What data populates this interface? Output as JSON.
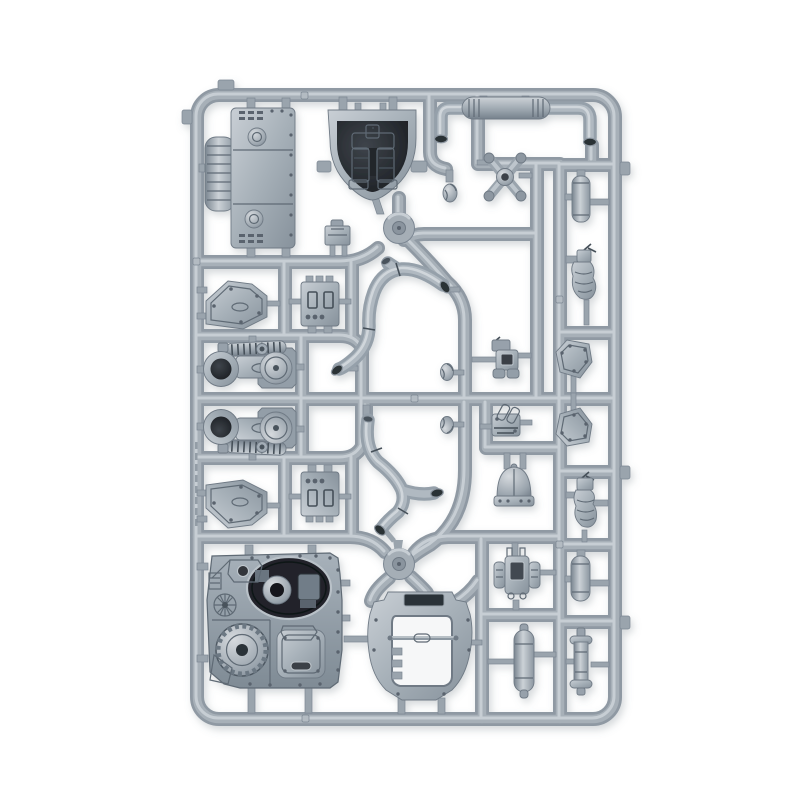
{
  "scene": {
    "type": "product photograph",
    "subject": "Injection-moulded plastic model sprue with unassembled miniature vehicle parts",
    "background_color": "#ffffff",
    "shadow_color": "#6a7480"
  },
  "sprue": {
    "frame_shape": "rounded rectangle",
    "hub_count": 2,
    "material": "light blue-grey polystyrene",
    "colors": {
      "plastic_light": "#c7ced4",
      "plastic_mid": "#9aa4ad",
      "plastic_dark": "#6f7a85",
      "recess_dark": "#2c3137"
    }
  },
  "parts": [
    {
      "id": "runner-frame",
      "label": "moulding frame and runner network with two round injection hubs"
    },
    {
      "id": "engine-block",
      "label": "boxy engine block with vent slots, round caps and ribbed cylinder"
    },
    {
      "id": "servitor-recess",
      "label": "oval recess holding a robotic servitor torso with twin legs"
    },
    {
      "id": "exhaust-assembly",
      "label": "twin down-curved exhaust pipes joined by a ribbed silencer"
    },
    {
      "id": "head-1",
      "label": "small bare head"
    },
    {
      "id": "servo-harness",
      "label": "X-shaped servo harness with four socket arms"
    },
    {
      "id": "cylinder-1",
      "label": "small plain cylinder canister"
    },
    {
      "id": "servitor-arm-1",
      "label": "small hunched servitor figure with antenna"
    },
    {
      "id": "clamp-box",
      "label": "small clamp box with stud feet"
    },
    {
      "id": "angled-plate-1",
      "label": "angular armour plate with bolt heads"
    },
    {
      "id": "stud-box-1",
      "label": "rectangular box with studs and triple rivet detail"
    },
    {
      "id": "weapon-assembly-1",
      "label": "weapon mount with muzzle ring, spring coil and round drum"
    },
    {
      "id": "head-2",
      "label": "small helmeted head"
    },
    {
      "id": "torso-front",
      "label": "torso front plate with recessed square vent"
    },
    {
      "id": "hatch-plate-1",
      "label": "pentagonal hatch plate with bolts"
    },
    {
      "id": "weapon-assembly-2",
      "label": "mirrored weapon mount with muzzle ring, coil and drum"
    },
    {
      "id": "head-3",
      "label": "small helmeted head, mirrored"
    },
    {
      "id": "hatch-plate-2",
      "label": "pentagonal hatch plate with bolts, mirrored"
    },
    {
      "id": "angled-plate-2",
      "label": "angular armour plate with bolt heads, mirrored"
    },
    {
      "id": "stud-box-2",
      "label": "rectangular box with studs, mirrored"
    },
    {
      "id": "engine-greeble",
      "label": "small engine chunk with piston cylinders"
    },
    {
      "id": "dome-vent",
      "label": "rounded dome vent on bolted base flange"
    },
    {
      "id": "power-pack",
      "label": "power pack with recessed core and side pods"
    },
    {
      "id": "servitor-arm-2",
      "label": "small segmented servo arm figure"
    },
    {
      "id": "cylinder-2",
      "label": "capped cylinder canister"
    },
    {
      "id": "smoke-launcher",
      "label": "flanged smoke launcher tube"
    },
    {
      "id": "fuel-tank",
      "label": "rounded fuel tank pill with ring seams"
    },
    {
      "id": "hull-side-panel",
      "label": "large hull side panel with turret recess, toothed gear wheel and access hatch"
    },
    {
      "id": "hatch-arch",
      "label": "arched hatch surround with open centre, cross rod and top slot"
    },
    {
      "id": "exhaust-pipe-1",
      "label": "S-curved exhaust pipe with flared mouths"
    },
    {
      "id": "exhaust-pipe-2",
      "label": "mirrored S-curved exhaust pipe with branch mouth"
    },
    {
      "id": "moulded-text",
      "label": "illegible moulded lettering on left rail"
    }
  ]
}
